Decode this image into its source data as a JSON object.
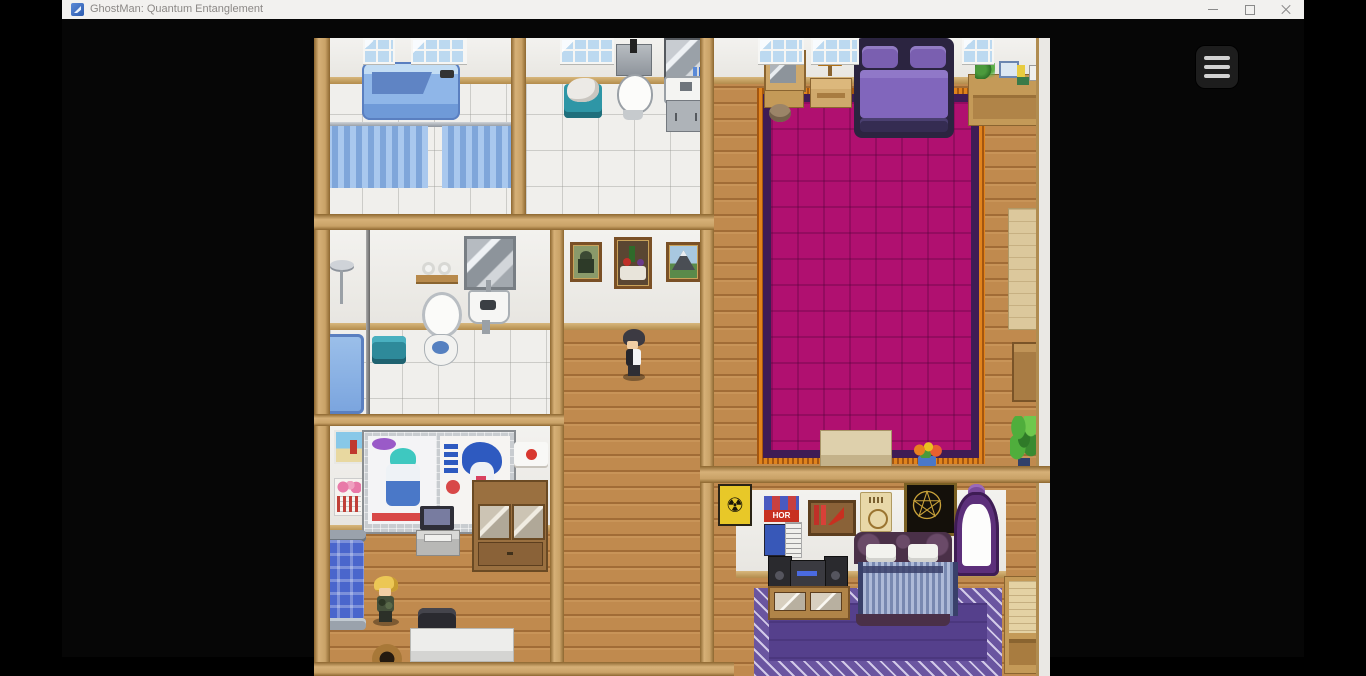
{
  "window": {
    "title": "GhostMan: Quantum Entanglement",
    "controls": {
      "minimize": "minimize",
      "maximize": "maximize",
      "close": "close"
    }
  },
  "icons": {
    "app": "rpg-maker-app-icon",
    "menu": "hamburger-icon",
    "minimize": "–",
    "maximize": "▢",
    "close": "✕"
  },
  "game": {
    "menu_button": "hamburger-menu",
    "view": "top-down interior map, letterboxed game canvas"
  },
  "posters": {
    "horror_text": "HOR"
  },
  "scene": {
    "characters": [
      {
        "name": "dark-haired-character",
        "location": "hallway",
        "outfit": "white shirt, black vest"
      },
      {
        "name": "blond-character",
        "location": "bottom-left-bedroom",
        "outfit": "dark green camo"
      }
    ],
    "rooms": [
      {
        "name": "bathroom-top-left",
        "objects": [
          "windows",
          "blue-bathtub",
          "shower-curtains",
          "tile-floor"
        ]
      },
      {
        "name": "bathroom-top-middle",
        "objects": [
          "window",
          "toilet",
          "laundry-basket",
          "mirror-cabinet",
          "sink",
          "tile-floor"
        ]
      },
      {
        "name": "bathroom-middle-left",
        "objects": [
          "shower-head",
          "shower-pole",
          "blue-bathtub",
          "teal-basket",
          "toilet",
          "toilet-paper-shelf",
          "wall-mirror",
          "urinal",
          "tile-floor"
        ]
      },
      {
        "name": "master-bedroom-right",
        "objects": [
          "windows",
          "purple-double-bed",
          "magenta-carpet",
          "dresser-with-mirror",
          "nightstand-with-lamp",
          "stool",
          "desk-with-plant-books-phone",
          "wood-bench",
          "flower-pot",
          "houseplant",
          "tall-board",
          "drawer-chest"
        ]
      },
      {
        "name": "bedroom-bottom-left",
        "objects": [
          "beach-poster",
          "flower-calendar",
          "anime-poster-wall",
          "envelope-poster",
          "computer-desk",
          "display-cabinet",
          "blue-bed",
          "office-chair",
          "white-desk",
          "wooden-pot"
        ]
      },
      {
        "name": "hallway",
        "objects": [
          "portrait-painting",
          "still-life-painting",
          "mountain-painting",
          "wood-floor"
        ]
      },
      {
        "name": "bedroom-bottom-right",
        "objects": [
          "radiation-poster",
          "horror-posters",
          "book-wall-shelf",
          "parchment-poster",
          "pentagram-tapestry",
          "ornate-purple-mirror",
          "stereo-table",
          "striped-bed",
          "purple-carpet",
          "side-desk"
        ]
      }
    ]
  },
  "colors": {
    "titlebar_bg": "#f2f1ef",
    "title_text": "#8b8886",
    "client_bg": "#060606",
    "menu_button_bg": "#1d1d1d",
    "wood": "#c08a4e",
    "tile": "#f0efec",
    "wall": "#edece8",
    "wall_trim": "#c9a267",
    "magenta_carpet": "#b01070",
    "carpet_fringe": "#e0831c",
    "purple_carpet": "#55408c",
    "bed_purple": "#8166bc"
  }
}
